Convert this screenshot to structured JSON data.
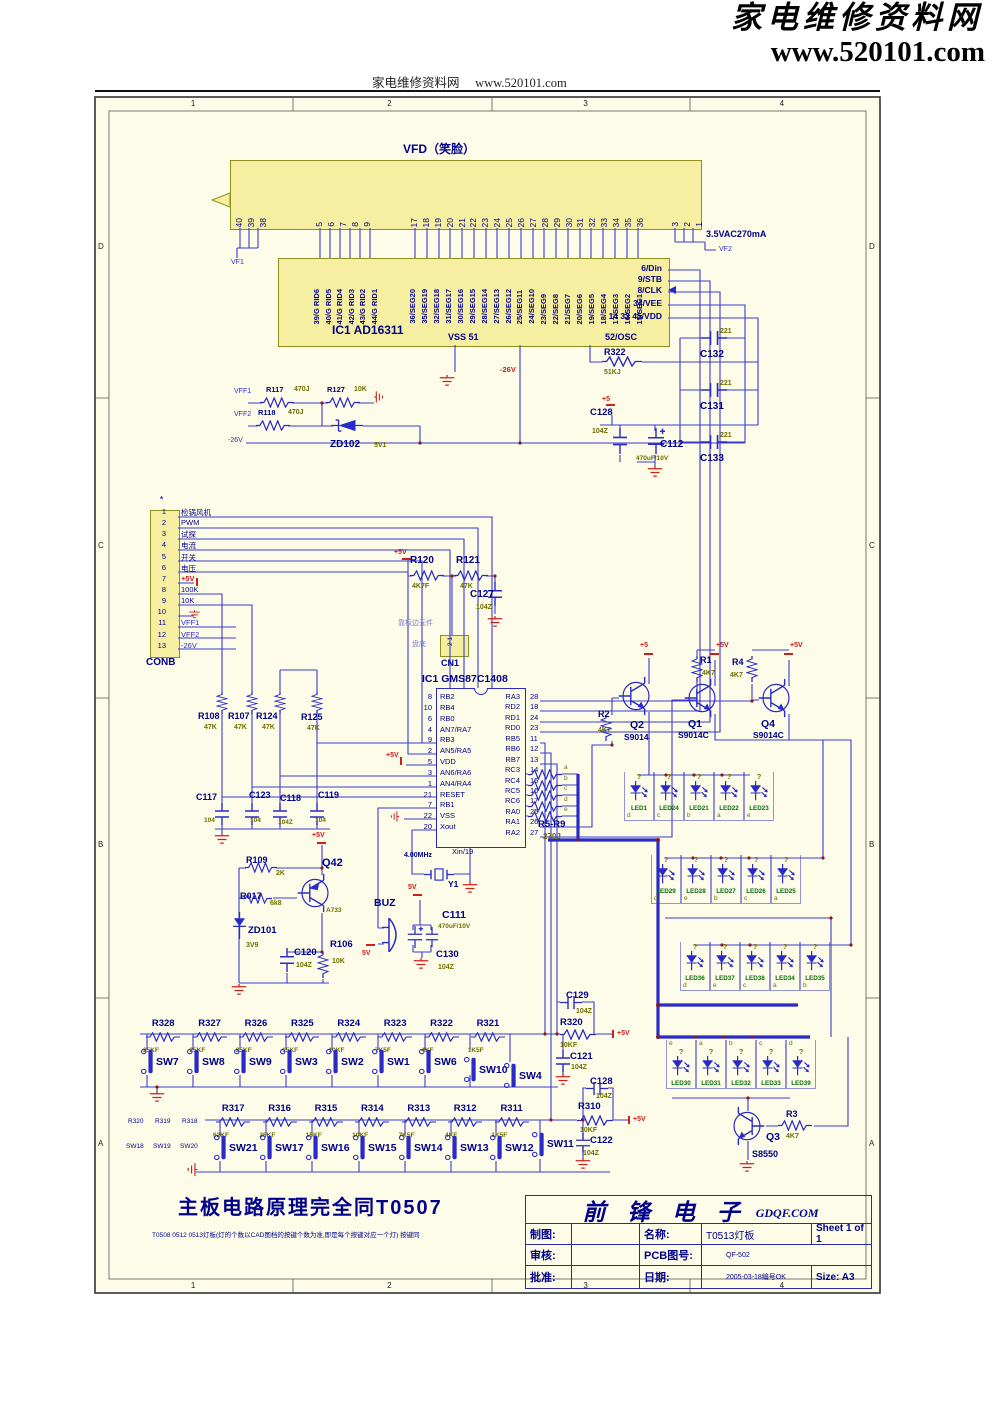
{
  "header": {
    "logo_line1": "家电维修资料网",
    "logo_line2": "www.520101.com",
    "center_text": "家电维修资料网",
    "center_url": "www.520101.com"
  },
  "frame": {
    "cols": [
      "1",
      "2",
      "3",
      "4"
    ],
    "rows": [
      "D",
      "C",
      "B",
      "A"
    ]
  },
  "vfd": {
    "title": "VFD（笑脸）",
    "pins_left": [
      "40",
      "39",
      "38"
    ],
    "pins_grid": [
      "5",
      "6",
      "7",
      "8",
      "9"
    ],
    "pins_seg": [
      "17",
      "18",
      "19",
      "20",
      "21",
      "22",
      "23",
      "24",
      "25",
      "26",
      "27",
      "28",
      "29",
      "30",
      "31",
      "32",
      "33",
      "34",
      "35",
      "36"
    ],
    "pins_right": [
      "3",
      "2",
      "1"
    ],
    "vf1": "VF1",
    "vf2": "VF2",
    "supply": "3.5VAC270mA"
  },
  "ic1": {
    "name": "IC1   AD16311",
    "grid_pins": [
      "39/G RID6",
      "40/G RID5",
      "41/G RID4",
      "42/G RID3",
      "43/G RID2",
      "44/G RID1"
    ],
    "seg_pins": [
      "36/SEG20",
      "35/SEG19",
      "32/SEG18",
      "31/SEG17",
      "30/SEG16",
      "29/SEG15",
      "28/SEG14",
      "27/SEG13",
      "26/SEG12",
      "25/SEG11",
      "24/SEG10",
      "23/SEG9",
      "22/SEG8",
      "21/SEG7",
      "20/SEG6",
      "19/SEG5",
      "18/SEG4",
      "17/SEG3",
      "16/SEG2",
      "15/SEG1"
    ],
    "right_pins": [
      "6/Din",
      "9/STB",
      "8/CLK",
      "34/VEE",
      "14 33 45/VDD"
    ],
    "vss": "VSS 51",
    "osc": "52/OSC"
  },
  "conb": {
    "name": "CONB",
    "star": "*",
    "rows": [
      {
        "n": "1",
        "net": "检锅风机"
      },
      {
        "n": "2",
        "net": "PWM"
      },
      {
        "n": "3",
        "net": "试探"
      },
      {
        "n": "4",
        "net": "电流"
      },
      {
        "n": "5",
        "net": "开关"
      },
      {
        "n": "6",
        "net": "电压"
      },
      {
        "n": "7",
        "net": "+5V"
      },
      {
        "n": "8",
        "net": "100K"
      },
      {
        "n": "9",
        "net": "10K"
      },
      {
        "n": "10",
        "net": ""
      },
      {
        "n": "11",
        "net": "VFF1"
      },
      {
        "n": "12",
        "net": "VFF2"
      },
      {
        "n": "13",
        "net": "-26V"
      }
    ]
  },
  "mcu": {
    "name": "IC1 GMS87C1408",
    "xin": "Xin/19",
    "left": [
      {
        "n": "8",
        "p": "RB2"
      },
      {
        "n": "10",
        "p": "RB4"
      },
      {
        "n": "6",
        "p": "RB0"
      },
      {
        "n": "4",
        "p": "AN7/RA7"
      },
      {
        "n": "9",
        "p": "RB3"
      },
      {
        "n": "2",
        "p": "AN5/RA5"
      },
      {
        "n": "5",
        "p": "VDD"
      },
      {
        "n": "3",
        "p": "AN6/RA6"
      },
      {
        "n": "1",
        "p": "AN4/RA4"
      },
      {
        "n": "21",
        "p": "RESET"
      },
      {
        "n": "7",
        "p": "RB1"
      },
      {
        "n": "22",
        "p": "VSS"
      },
      {
        "n": "20",
        "p": "Xout"
      }
    ],
    "right": [
      {
        "p": "RA3",
        "n": "28"
      },
      {
        "p": "RD2",
        "n": "18"
      },
      {
        "p": "RD1",
        "n": "24"
      },
      {
        "p": "RD0",
        "n": "23"
      },
      {
        "p": "RB5",
        "n": "11"
      },
      {
        "p": "RB6",
        "n": "12"
      },
      {
        "p": "RB7",
        "n": "13"
      },
      {
        "p": "RC3",
        "n": "14"
      },
      {
        "p": "RC4",
        "n": "15"
      },
      {
        "p": "RC5",
        "n": "16"
      },
      {
        "p": "RC6",
        "n": "17"
      },
      {
        "p": "RA0",
        "n": "25"
      },
      {
        "p": "RA1",
        "n": "26"
      },
      {
        "p": "RA2",
        "n": "27"
      }
    ]
  },
  "parts": {
    "r322": {
      "ref": "R322",
      "val": "51KJ"
    },
    "c132": {
      "ref": "C132",
      "val": "221"
    },
    "c131": {
      "ref": "C131",
      "val": "221"
    },
    "c133": {
      "ref": "C133",
      "val": "221"
    },
    "c128a": {
      "ref": "C128",
      "val": "104Z"
    },
    "c112": {
      "ref": "C112",
      "val": "470uF/10V"
    },
    "r117": {
      "ref": "R117",
      "val": "470J"
    },
    "r127": {
      "ref": "R127",
      "val": "10K"
    },
    "r118": {
      "ref": "R118",
      "val": "470J"
    },
    "zd102": {
      "ref": "ZD102",
      "val": "5V1"
    },
    "r120": {
      "ref": "R120",
      "val": "4K7F"
    },
    "r121": {
      "ref": "R121",
      "val": "47K"
    },
    "c127": {
      "ref": "C127",
      "val": "104Z"
    },
    "cn1": {
      "ref": "CN1",
      "pins": "2 1",
      "note_edge": "靠板边元件",
      "note_pan": "盘底"
    },
    "r108": {
      "ref": "R108",
      "val": "47K"
    },
    "r107": {
      "ref": "R107",
      "val": "47K"
    },
    "r124": {
      "ref": "R124",
      "val": "47K"
    },
    "r125": {
      "ref": "R125",
      "val": "47K"
    },
    "c117": {
      "ref": "C117",
      "val": "104"
    },
    "c123": {
      "ref": "C123",
      "val": "104"
    },
    "c118": {
      "ref": "C118",
      "val": "104Z"
    },
    "c119": {
      "ref": "C119",
      "val": "104"
    },
    "r109": {
      "ref": "R109",
      "val": "2K"
    },
    "r017": {
      "ref": "R017",
      "val": "6k8"
    },
    "q42": {
      "ref": "Q42",
      "val": "A733"
    },
    "zd101": {
      "ref": "ZD101",
      "val": "3V9"
    },
    "c120": {
      "ref": "C120",
      "val": "104Z"
    },
    "r106": {
      "ref": "R106",
      "val": "10K"
    },
    "buz": {
      "ref": "BUZ"
    },
    "c111": {
      "ref": "C111",
      "val": "470uF/10V"
    },
    "c130": {
      "ref": "C130",
      "val": "104Z"
    },
    "y1": {
      "ref": "Y1",
      "val": "4.00MHz"
    },
    "r2": {
      "ref": "R2",
      "val": "4K7"
    },
    "q2": {
      "ref": "Q2",
      "val": "S9014"
    },
    "r1": {
      "ref": "R1",
      "val": "4K7"
    },
    "q1": {
      "ref": "Q1",
      "val": "S9014C"
    },
    "r4": {
      "ref": "R4",
      "val": "4K7"
    },
    "q4": {
      "ref": "Q4",
      "val": "S9014C"
    },
    "r3": {
      "ref": "R3",
      "val": "4K7"
    },
    "q3": {
      "ref": "Q3",
      "val": "S8550"
    },
    "r59": {
      "ref": "R5-R9",
      "val": "270J",
      "letters": [
        {
          "lt": "a"
        },
        {
          "lt": "b"
        },
        {
          "lt": "c"
        },
        {
          "lt": "d"
        },
        {
          "lt": "e"
        }
      ]
    },
    "r320": {
      "ref": "R320",
      "val": "10KF"
    },
    "c129": {
      "ref": "C129",
      "val": "104Z"
    },
    "c121": {
      "ref": "C121",
      "val": "104Z"
    },
    "r310": {
      "ref": "R310",
      "val": "10KF"
    },
    "c128b": {
      "ref": "C128",
      "val": "104Z"
    },
    "c122": {
      "ref": "C122",
      "val": "104Z"
    }
  },
  "nets": {
    "p5v": "+5V",
    "p5": "+5",
    "v5": "5V",
    "n26": "-26V",
    "vff1": "VFF1",
    "vff2": "VFF2"
  },
  "leds": {
    "row1": [
      {
        "q": "?",
        "ref": "LED1",
        "lt": "d"
      },
      {
        "q": "?",
        "ref": "LED24",
        "lt": "c"
      },
      {
        "q": "?",
        "ref": "LED21",
        "lt": "b"
      },
      {
        "q": "?",
        "ref": "LED22",
        "lt": "a"
      },
      {
        "q": "?",
        "ref": "LED23",
        "lt": "e"
      }
    ],
    "row2": [
      {
        "q": "?",
        "ref": "LED29",
        "lt": "d"
      },
      {
        "q": "?",
        "ref": "LED28",
        "lt": "e"
      },
      {
        "q": "?",
        "ref": "LED27",
        "lt": "b"
      },
      {
        "q": "?",
        "ref": "LED26",
        "lt": "c"
      },
      {
        "q": "?",
        "ref": "LED25",
        "lt": "a"
      }
    ],
    "row3": [
      {
        "q": "?",
        "ref": "LED36",
        "lt": "d"
      },
      {
        "q": "?",
        "ref": "LED37",
        "lt": "e"
      },
      {
        "q": "?",
        "ref": "LED38",
        "lt": "c"
      },
      {
        "q": "?",
        "ref": "LED34",
        "lt": "a"
      },
      {
        "q": "?",
        "ref": "LED35",
        "lt": "b"
      }
    ],
    "row4": [
      {
        "q": "?",
        "ref": "LED30",
        "lt": "e"
      },
      {
        "q": "?",
        "ref": "LED31",
        "lt": "a"
      },
      {
        "q": "?",
        "ref": "LED32",
        "lt": "b"
      },
      {
        "q": "?",
        "ref": "LED33",
        "lt": "c"
      },
      {
        "q": "?",
        "ref": "LED39",
        "lt": "d"
      }
    ]
  },
  "keys": {
    "row1_res": [
      {
        "ref": "R328",
        "val": "25KF"
      },
      {
        "ref": "R327",
        "val": "25KF"
      },
      {
        "ref": "R326",
        "val": "25KF"
      },
      {
        "ref": "R325",
        "val": "15KF"
      },
      {
        "ref": "R324",
        "val": "10KF"
      },
      {
        "ref": "R323",
        "val": "7K5F"
      },
      {
        "ref": "R322",
        "val": "4KF"
      },
      {
        "ref": "R321",
        "val": "1K5F"
      }
    ],
    "row1_sw": [
      "SW7",
      "SW8",
      "SW9",
      "SW3",
      "SW2",
      "SW1",
      "SW6",
      "SW10",
      "SW4"
    ],
    "row2_res": [
      {
        "ref": "R317",
        "val": "62KF"
      },
      {
        "ref": "R316",
        "val": "25KF"
      },
      {
        "ref": "R315",
        "val": "15KF"
      },
      {
        "ref": "R314",
        "val": "10KF"
      },
      {
        "ref": "R313",
        "val": "7K5F"
      },
      {
        "ref": "R312",
        "val": "4KF"
      },
      {
        "ref": "R311",
        "val": "1K5F"
      }
    ],
    "row2_sw": [
      "SW21",
      "SW17",
      "SW16",
      "SW15",
      "SW14",
      "SW13",
      "SW12"
    ],
    "sw11": "SW11",
    "side_res": [
      "R320",
      "R319",
      "R318"
    ],
    "side_sw": [
      "SW18",
      "SW19",
      "SW20"
    ]
  },
  "footer": {
    "note_main": "主板电路原理完全同T0507",
    "note_sub": "T0508 0512 0513灯板(灯的个数以CAD图档的按键个数为准,即是每个按键对应一个灯) 按键同"
  },
  "titleblock": {
    "company": "前 锋 电 子",
    "company_url": "GDQF.COM",
    "draw_label": "制图:",
    "check_label": "审核:",
    "approve_label": "批准:",
    "name_label": "名称:",
    "name_value": "T0513灯板",
    "sheet": "Sheet 1 of 1",
    "pcb_label": "PCB图号:",
    "pcb_value": "QF-502",
    "date_label": "日期:",
    "date_value": "2005-03-18编号OK",
    "size": "Size:  A3"
  }
}
